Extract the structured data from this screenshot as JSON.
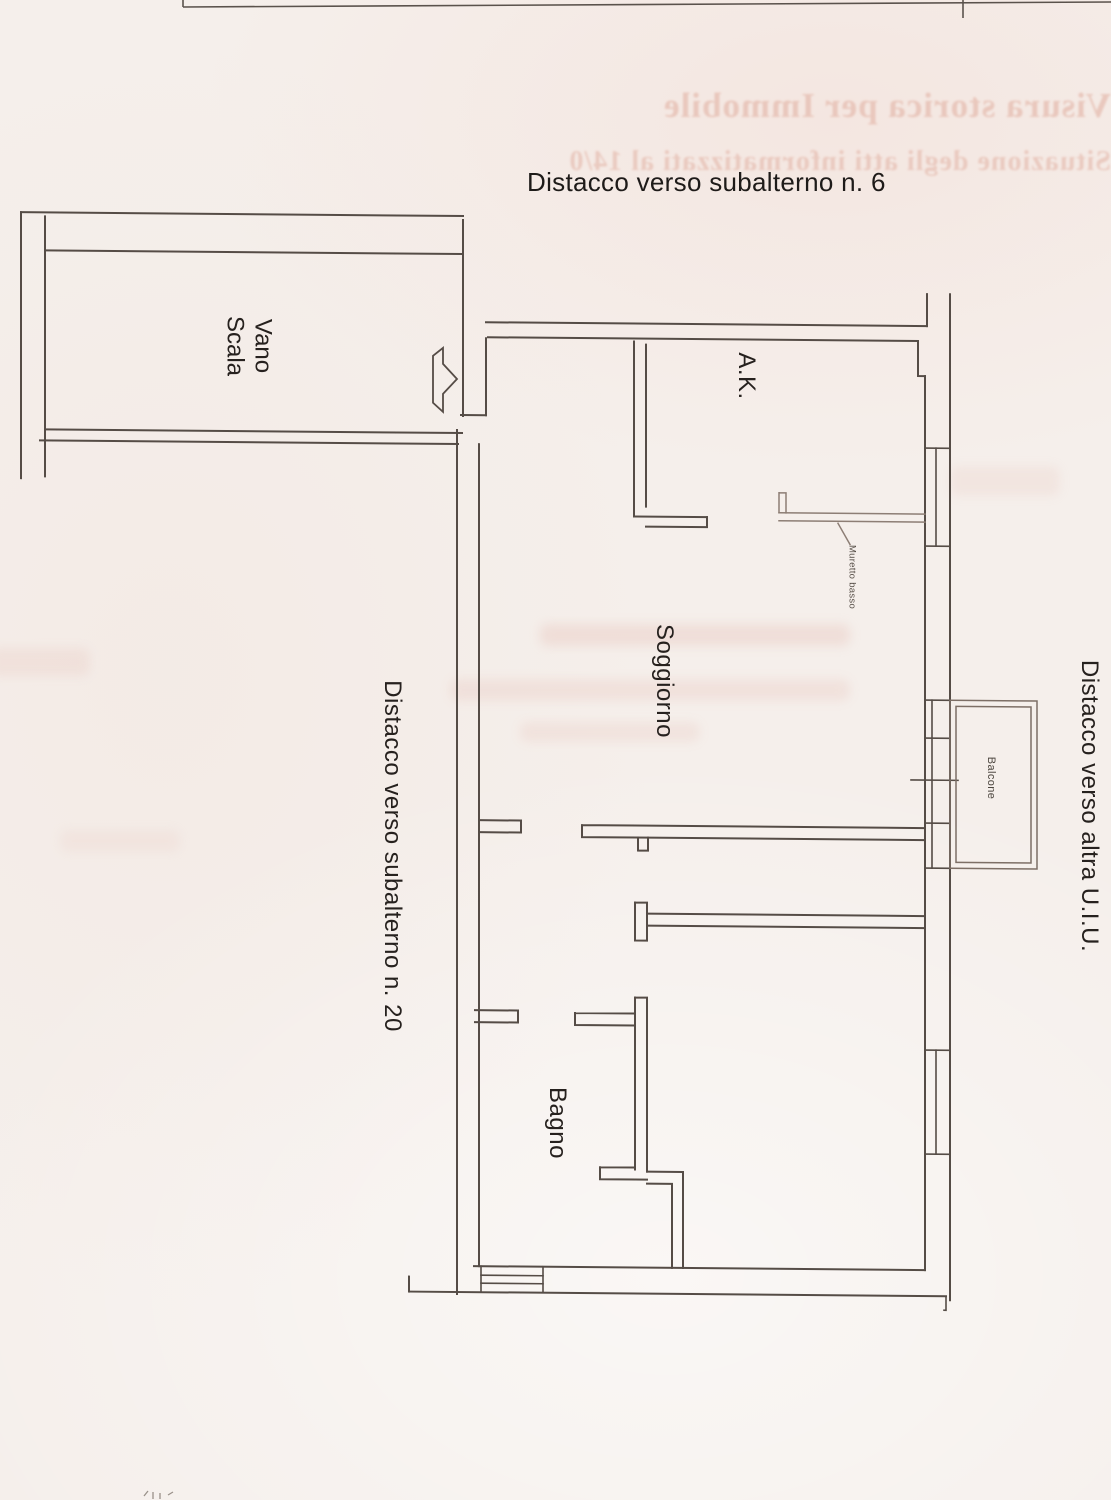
{
  "document": {
    "title": "Distacco verso subalterno n. 6",
    "ghost_bleedthrough": {
      "line1": "Visura storica per Immobile",
      "line2": "Situazione degli atti informatizzati al 14/0"
    }
  },
  "floor_plan": {
    "rooms": [
      {
        "name": "Vano Scala",
        "label_line1": "Vano",
        "label_line2": "Scala"
      },
      {
        "name": "Angolo cottura",
        "label": "A.K."
      },
      {
        "name": "Soggiorno",
        "label": "Soggiorno"
      },
      {
        "name": "Bagno",
        "label": "Bagno"
      },
      {
        "name": "Balcone",
        "label": "Balcone"
      }
    ],
    "annotations": {
      "muretto_basso": "Muretto basso",
      "distacco_sub_20": "Distacco verso subalterno n. 20",
      "distacco_altra_uiu": "Distacco verso altra U.I.U."
    },
    "colors": {
      "paper": "#f5efeb",
      "ink": "#554c46",
      "ink_light": "#8d7e75",
      "ghost_pink": "#e6bfb3",
      "text": "#26211e"
    }
  }
}
